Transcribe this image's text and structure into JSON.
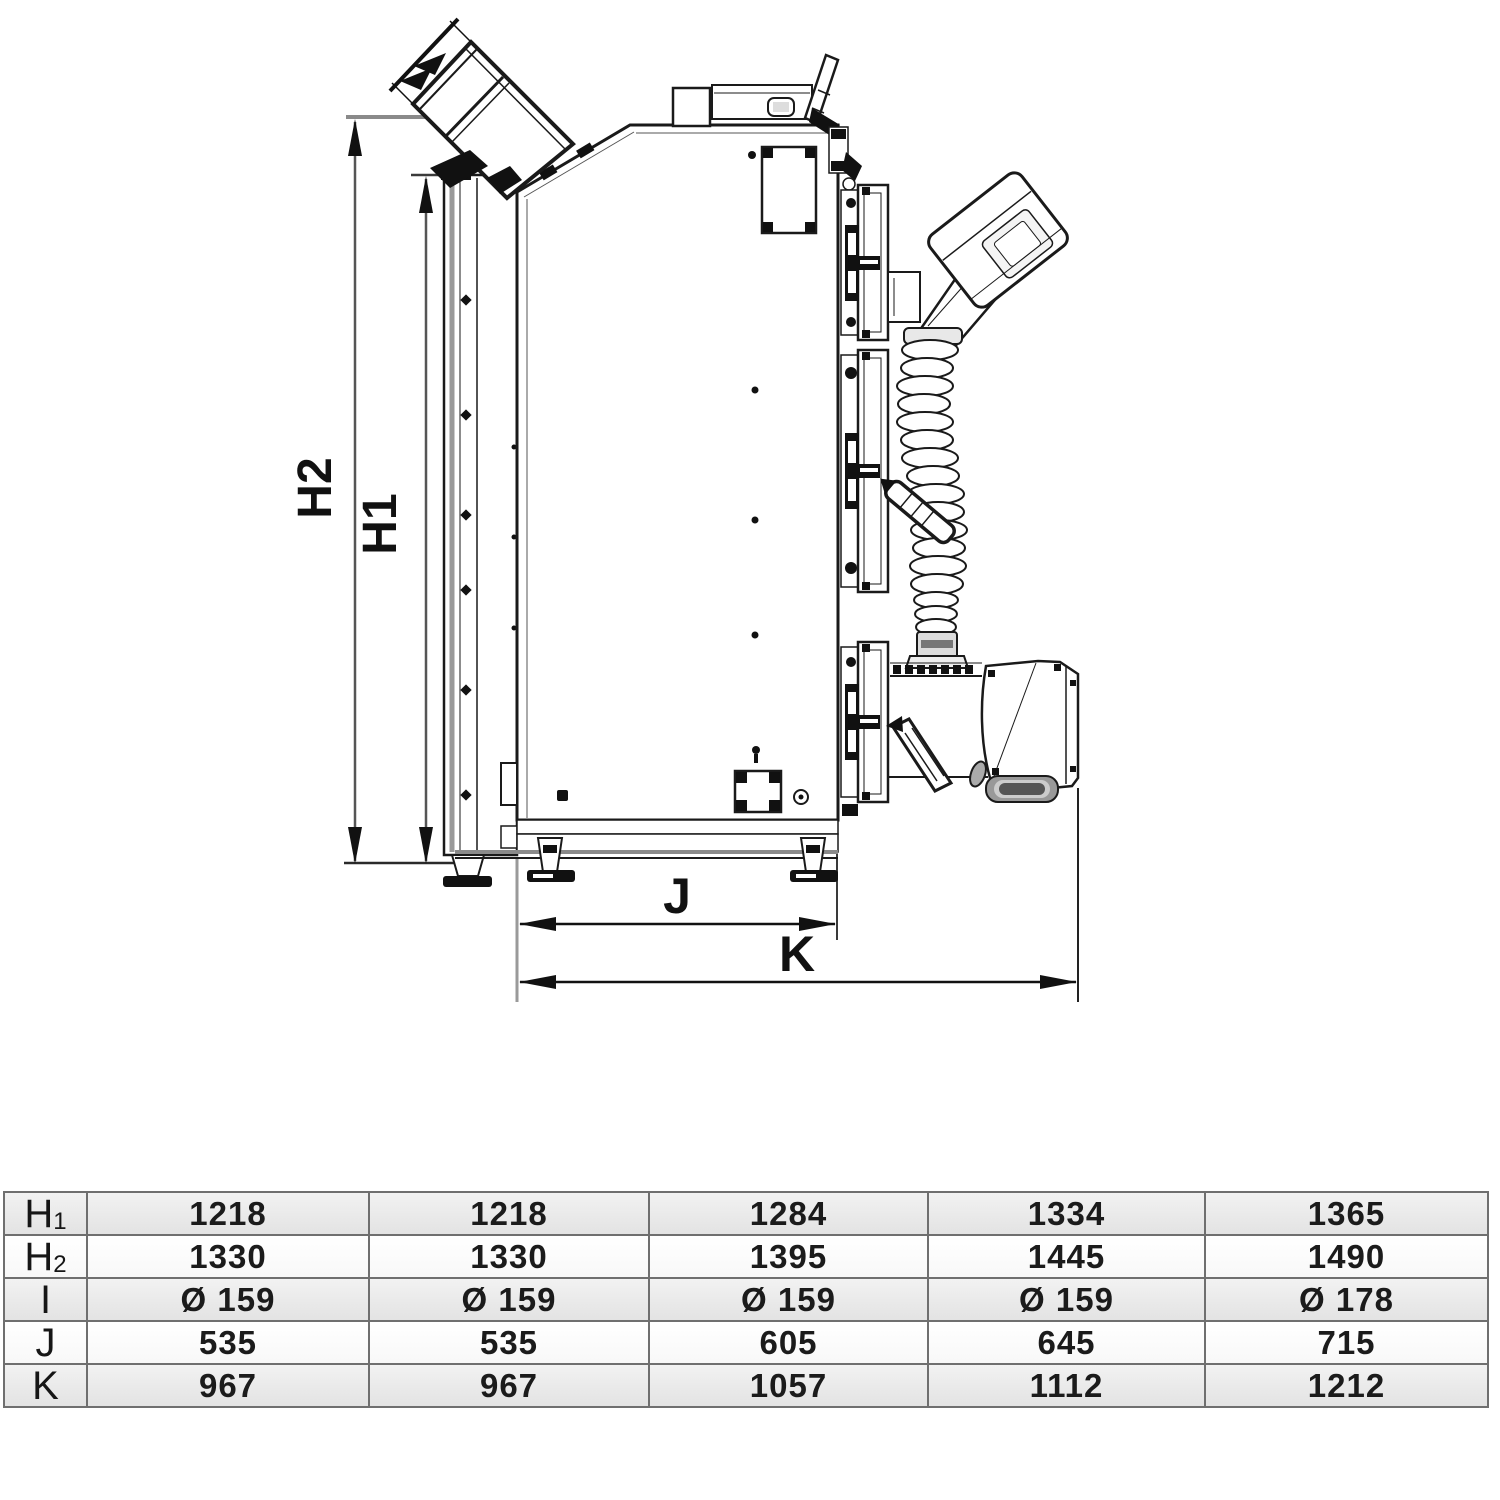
{
  "drawing": {
    "dims": {
      "h2": "H2",
      "h1": "H1",
      "j": "J",
      "k": "K"
    }
  },
  "table": {
    "rows": [
      {
        "label_main": "H",
        "label_sub": "1",
        "values": [
          "1218",
          "1218",
          "1284",
          "1334",
          "1365"
        ]
      },
      {
        "label_main": "H",
        "label_sub": "2",
        "values": [
          "1330",
          "1330",
          "1395",
          "1445",
          "1490"
        ]
      },
      {
        "label_main": "I",
        "label_sub": "",
        "values": [
          "Ø 159",
          "Ø 159",
          "Ø 159",
          "Ø 159",
          "Ø 178"
        ]
      },
      {
        "label_main": "J",
        "label_sub": "",
        "values": [
          "535",
          "535",
          "605",
          "645",
          "715"
        ]
      },
      {
        "label_main": "K",
        "label_sub": "",
        "values": [
          "967",
          "967",
          "1057",
          "1112",
          "1212"
        ]
      }
    ]
  },
  "colors": {
    "line": "#1a1a1a",
    "gray_line": "#8a8a8a",
    "row_shade": "#e9e9e9",
    "row_plain": "#ffffff",
    "table_border": "#6f6f6f"
  }
}
